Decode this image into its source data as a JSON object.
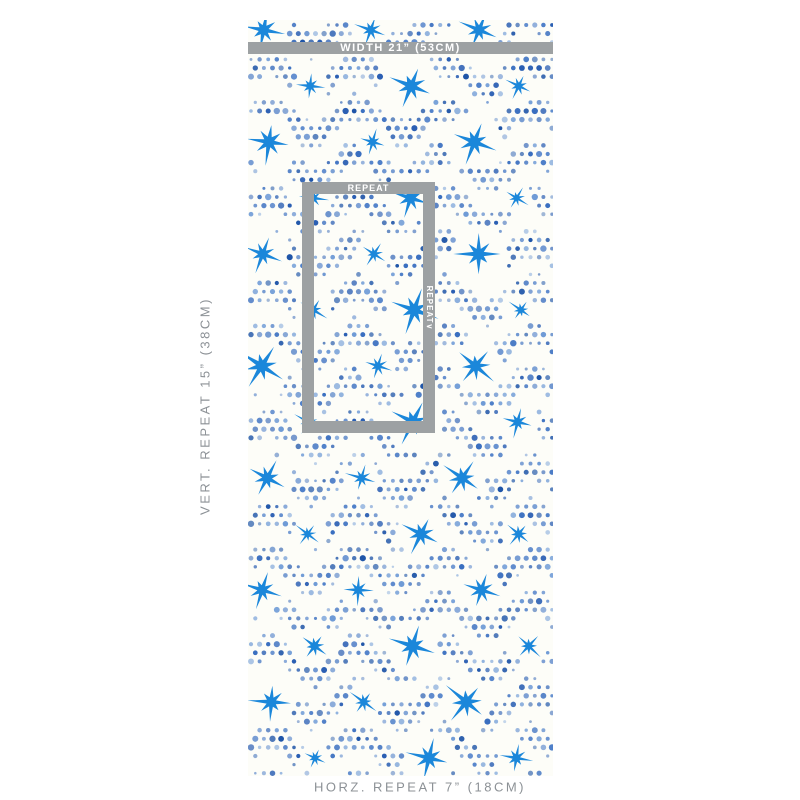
{
  "page": {
    "background": "#ffffff"
  },
  "annotations": {
    "width_label": "WIDTH 21” (53CM)",
    "vertical_repeat_label": "VERT. REPEAT 15” (38CM)",
    "horizontal_repeat_label": "HORZ. REPEAT 7” (18CM)",
    "repeat_box": {
      "top_label": "REPEAT",
      "side_label": "REPEAT",
      "side_arrow": "∨"
    },
    "bar_color": "#9da1a3",
    "text_color": "#8c9196",
    "bar_text_color": "#ffffff"
  },
  "swatch": {
    "description": "white wallpaper with blue dotted wave bands and scattered blue eight-point stars",
    "background": "#fdfdf8",
    "pattern": {
      "star_color": "#1b87da",
      "dot_colors": [
        "#2b5fb3",
        "#3a6fc0",
        "#4f80c9",
        "#6f9bd6",
        "#1f55a8"
      ],
      "width": 305,
      "height": 756,
      "dot_spacing": 8.6,
      "star_spacing_x": 104,
      "star_spacing_y": 56
    }
  }
}
